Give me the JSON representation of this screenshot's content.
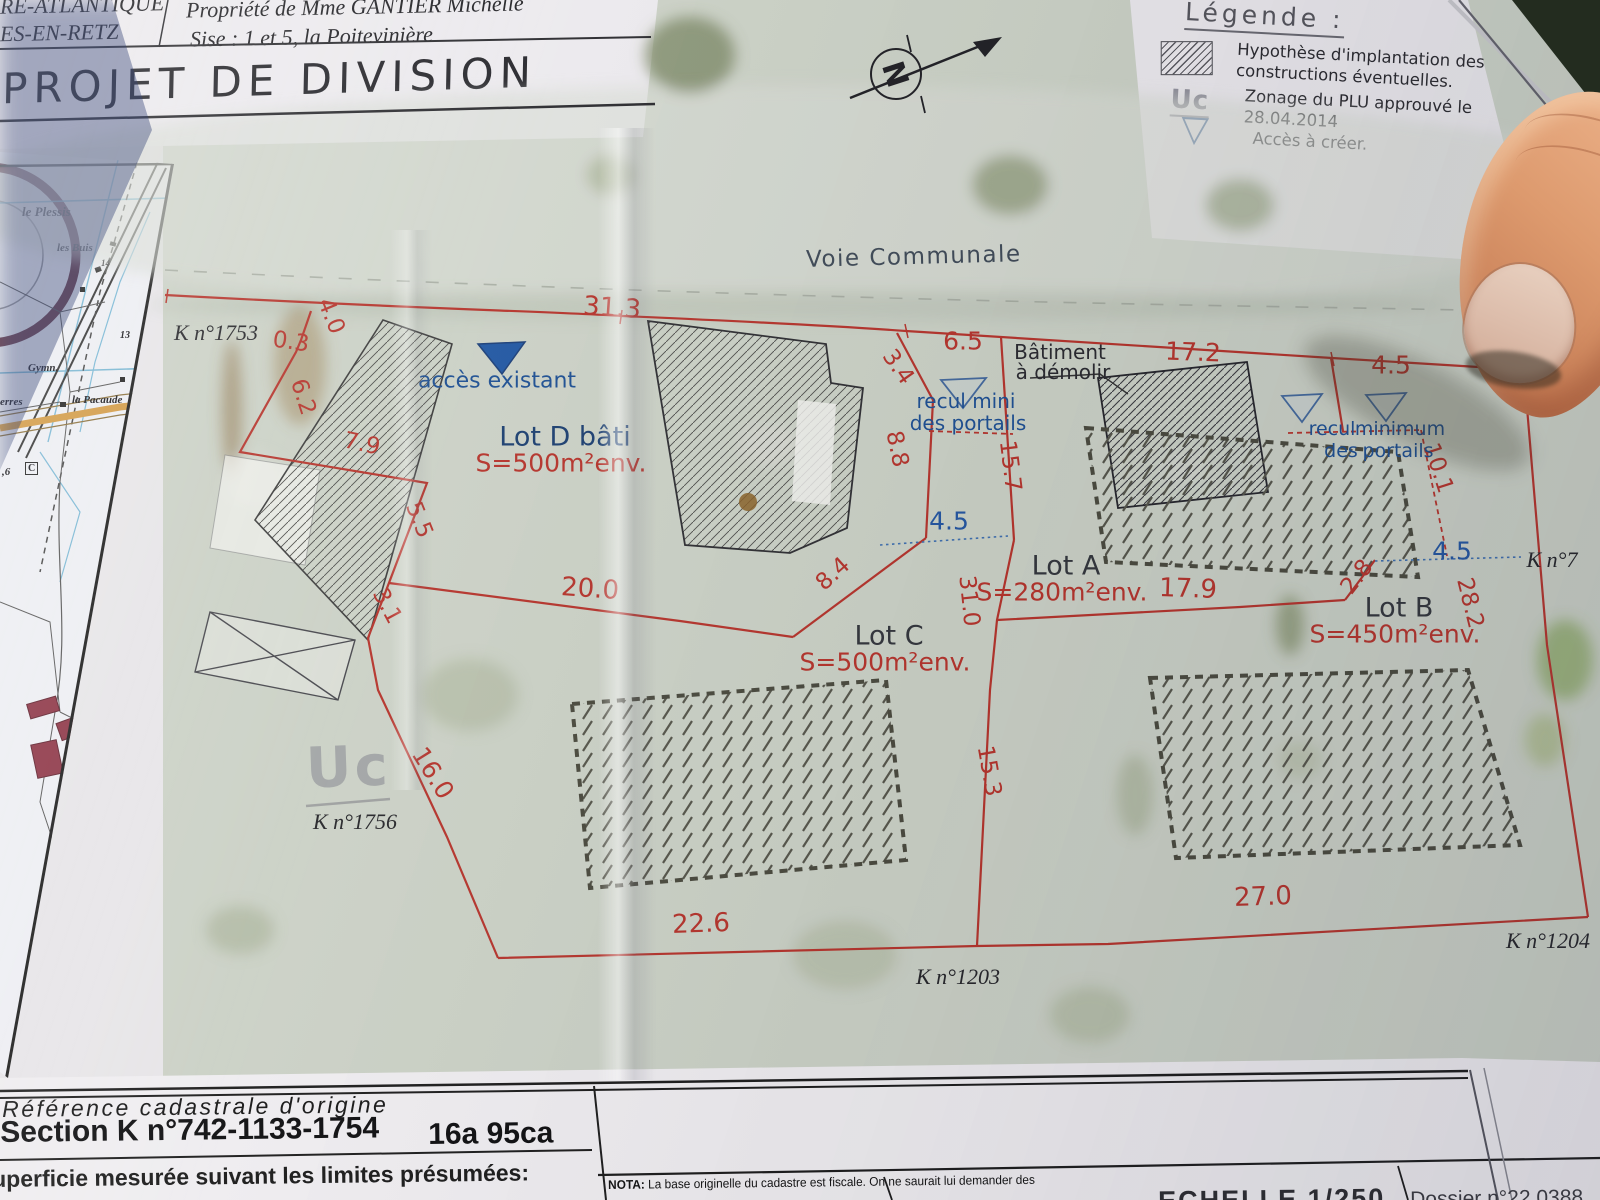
{
  "header": {
    "left_line1": "RE-ATLANTIQUE",
    "left_line2": "ES-EN-RETZ",
    "owner": "Propriété de Mme GANTIER Michelle",
    "address": "Sise : 1 et 5, la Poitevinière",
    "title": "PROJET DE DIVISION"
  },
  "legend": {
    "title": "Légende :",
    "items": [
      {
        "icon": "hatch-box-icon",
        "lines": [
          "Hypothèse d'implantation des",
          "constructions éventuelles."
        ]
      },
      {
        "icon": "uc-zoning-icon",
        "symbol": "Uc",
        "lines": [
          "Zonage du PLU approuvé le",
          "28.04.2014"
        ]
      },
      {
        "icon": "triangle-down-icon",
        "glyph": "▽",
        "lines": [
          "Accès à créer."
        ]
      }
    ]
  },
  "plan": {
    "north_label": "N",
    "road_label": "Voie Communale",
    "zoning_watermark": "Uc",
    "lots": [
      {
        "name": "Lot D bâti",
        "area": "S=500m²env.",
        "x": 565,
        "y": 437,
        "navy": true
      },
      {
        "name": "Lot A",
        "area": "S=280m²env.",
        "x": 1066,
        "y": 566
      },
      {
        "name": "Lot C",
        "area": "S=500m²env.",
        "x": 889,
        "y": 636
      },
      {
        "name": "Lot B",
        "area": "S=450m²env.",
        "x": 1399,
        "y": 608
      }
    ],
    "parcels": [
      {
        "t": "K n°1753",
        "x": 216,
        "y": 333
      },
      {
        "t": "K n°1756",
        "x": 355,
        "y": 822
      },
      {
        "t": "K n°1203",
        "x": 958,
        "y": 977
      },
      {
        "t": "K n°1204",
        "x": 1548,
        "y": 941
      },
      {
        "t": "K n°7",
        "x": 1552,
        "y": 560
      }
    ],
    "dimensions": [
      {
        "t": "31.3",
        "x": 612,
        "y": 308,
        "r": 4,
        "s": 26
      },
      {
        "t": "4.0",
        "x": 331,
        "y": 316,
        "r": 68
      },
      {
        "t": "0.3",
        "x": 291,
        "y": 342,
        "r": 8
      },
      {
        "t": "6.2",
        "x": 303,
        "y": 397,
        "r": 72
      },
      {
        "t": "7.9",
        "x": 362,
        "y": 444,
        "r": 12
      },
      {
        "t": "5.5",
        "x": 419,
        "y": 520,
        "r": 68
      },
      {
        "t": "3.1",
        "x": 387,
        "y": 606,
        "r": 62
      },
      {
        "t": "20.0",
        "x": 590,
        "y": 589,
        "r": 4,
        "s": 26
      },
      {
        "t": "16.0",
        "x": 433,
        "y": 773,
        "r": 58,
        "s": 25
      },
      {
        "t": "3.4",
        "x": 898,
        "y": 367,
        "r": 55
      },
      {
        "t": "6.5",
        "x": 963,
        "y": 341,
        "s": 25
      },
      {
        "t": "8.8",
        "x": 897,
        "y": 449,
        "r": 78
      },
      {
        "t": "8.4",
        "x": 833,
        "y": 574,
        "r": -42
      },
      {
        "t": "15.7",
        "x": 1010,
        "y": 466,
        "r": 83
      },
      {
        "t": "4.5",
        "x": 949,
        "y": 521,
        "c": "blue",
        "s": 25
      },
      {
        "t": "31.0",
        "x": 969,
        "y": 601,
        "r": 84
      },
      {
        "t": "15.3",
        "x": 989,
        "y": 771,
        "r": 80
      },
      {
        "t": "17.9",
        "x": 1188,
        "y": 589,
        "r": 2,
        "s": 26
      },
      {
        "t": "2.8",
        "x": 1357,
        "y": 577,
        "r": -52
      },
      {
        "t": "4.5",
        "x": 1452,
        "y": 551,
        "c": "blue",
        "s": 25
      },
      {
        "t": "28.2",
        "x": 1470,
        "y": 603,
        "r": 76
      },
      {
        "t": "10.1",
        "x": 1438,
        "y": 468,
        "r": 72
      },
      {
        "t": "17.2",
        "x": 1193,
        "y": 352,
        "r": 2,
        "s": 25
      },
      {
        "t": "4.5",
        "x": 1391,
        "y": 365,
        "s": 25
      },
      {
        "t": "22.6",
        "x": 701,
        "y": 924,
        "r": -2,
        "s": 26
      },
      {
        "t": "27.0",
        "x": 1263,
        "y": 897,
        "r": -2,
        "s": 26
      }
    ],
    "annotations_blue": [
      {
        "t": "accès existant",
        "x": 497,
        "y": 381,
        "s": 22
      },
      {
        "t": "recul mini",
        "x": 966,
        "y": 401,
        "s": 20
      },
      {
        "t": "des portails",
        "x": 968,
        "y": 423,
        "s": 20
      },
      {
        "t": "recul",
        "x": 1332,
        "y": 429,
        "s": 19
      },
      {
        "t": "minimum",
        "x": 1400,
        "y": 429,
        "s": 19
      },
      {
        "t": "des",
        "x": 1341,
        "y": 451,
        "s": 19
      },
      {
        "t": "portails",
        "x": 1398,
        "y": 451,
        "s": 19
      }
    ],
    "annotations_dark": [
      {
        "t": "Bâtiment",
        "x": 1060,
        "y": 352
      },
      {
        "t": "à démolir",
        "x": 1063,
        "y": 372
      }
    ]
  },
  "inset_map": {
    "labels": [
      {
        "t": "le Plessis",
        "x": 22,
        "y": 52,
        "s": 13
      },
      {
        "t": "les Buis",
        "x": 57,
        "y": 90,
        "s": 11
      },
      {
        "t": "14",
        "x": 101,
        "y": 106,
        "s": 9
      },
      {
        "t": "13",
        "x": 120,
        "y": 178,
        "s": 10
      },
      {
        "t": "Gymn.",
        "x": 28,
        "y": 210,
        "s": 11
      },
      {
        "t": "la Pacaude",
        "x": 72,
        "y": 242,
        "s": 11
      },
      {
        "t": "erres",
        "x": 0,
        "y": 244,
        "s": 11
      },
      {
        "t": ",6",
        "x": 2,
        "y": 314,
        "s": 11
      },
      {
        "t": "C",
        "x": 25,
        "y": 310,
        "s": 10,
        "boxed": true
      }
    ]
  },
  "footer": {
    "reference_title": "Référence cadastrale d'origine",
    "section": "Section K n°742-1133-1754",
    "area": "16a 95ca",
    "superficie": "uperficie mesurée suivant les limites présumées:",
    "nota_bold": "NOTA:",
    "nota": " La base originelle du cadastre est fiscale. On ne saurait lui demander des",
    "echelle": "ECHELLE 1/250",
    "dossier": "Dossier n°22 0388"
  }
}
